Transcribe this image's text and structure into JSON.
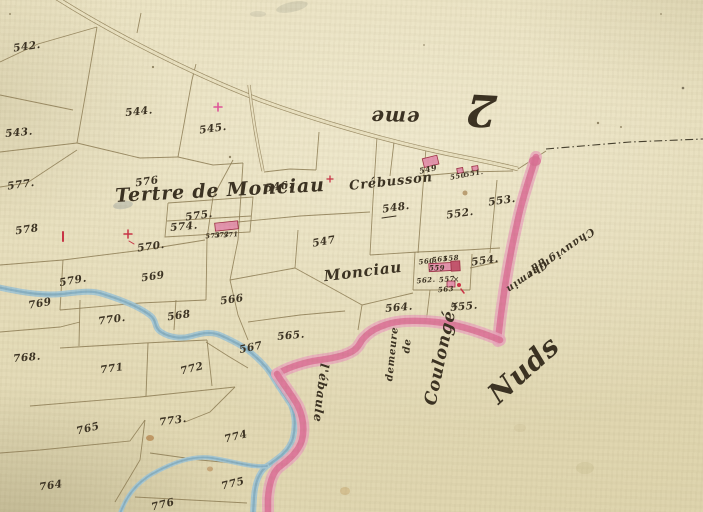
{
  "map": {
    "colors": {
      "paper_light": "#eae2c2",
      "paper_dark": "#ded4ad",
      "ink": "#3a3122",
      "boundary_line": "#8d7c55",
      "water_edge": "#6d9db6",
      "water_fill": "#a3c6d4",
      "road_pink": "#da7195",
      "road_pink_light": "#e9a8bd",
      "building_fill": "#e394ad",
      "building_outline": "#9c2e44",
      "survey_red": "#cb3246",
      "stain_brown": "#a8672a"
    },
    "labels": [
      {
        "id": "tertre-de-monciau",
        "text": "Tertre de Monciau",
        "x": 220,
        "y": 191,
        "rot": -3,
        "size": 19,
        "kind": "script"
      },
      {
        "id": "crebusson",
        "text": "Crébusson",
        "x": 391,
        "y": 182,
        "rot": -6,
        "size": 13,
        "kind": "script"
      },
      {
        "id": "monciau",
        "text": "Monciau",
        "x": 363,
        "y": 272,
        "rot": -7,
        "size": 15,
        "kind": "script"
      },
      {
        "id": "nuds",
        "text": "Nuds",
        "x": 524,
        "y": 370,
        "rot": -42,
        "size": 28,
        "kind": "script"
      },
      {
        "id": "sheet-number",
        "text": "2",
        "x": 481,
        "y": 109,
        "rot": 183,
        "size": 44,
        "kind": "script"
      },
      {
        "id": "sheet-suffix",
        "text": "eme",
        "x": 395,
        "y": 118,
        "rot": 181,
        "size": 20,
        "kind": "script"
      },
      {
        "id": "chemin-line-1",
        "text": "Chemin",
        "x": 526,
        "y": 276,
        "rot": 145,
        "size": 10,
        "kind": "script"
      },
      {
        "id": "chemin-line-2",
        "text": "du",
        "x": 537,
        "y": 264,
        "rot": 145,
        "size": 10,
        "kind": "script"
      },
      {
        "id": "chemin-line-3",
        "text": "Chauvignier",
        "x": 560,
        "y": 253,
        "rot": 145,
        "size": 10.5,
        "kind": "script"
      },
      {
        "id": "demeure",
        "text": "demeure",
        "x": 393,
        "y": 354,
        "rot": -84,
        "size": 10,
        "kind": "script"
      },
      {
        "id": "demeure-de",
        "text": "de",
        "x": 408,
        "y": 346,
        "rot": -84,
        "size": 10,
        "kind": "script"
      },
      {
        "id": "coulonge",
        "text": "Coulongé",
        "x": 441,
        "y": 358,
        "rot": -78,
        "size": 17,
        "kind": "script"
      },
      {
        "id": "ebaule",
        "text": "l'ébaule",
        "x": 321,
        "y": 393,
        "rot": 97,
        "size": 12,
        "kind": "script"
      },
      {
        "id": "parcel-542",
        "text": "542.",
        "x": 27,
        "y": 47,
        "rot": -8,
        "size": 10.5,
        "kind": "number"
      },
      {
        "id": "parcel-543",
        "text": "543.",
        "x": 19,
        "y": 133,
        "rot": -5,
        "size": 10.5,
        "kind": "number"
      },
      {
        "id": "parcel-544",
        "text": "544.",
        "x": 139,
        "y": 112,
        "rot": -6,
        "size": 10.5,
        "kind": "number"
      },
      {
        "id": "parcel-545",
        "text": "545.",
        "x": 213,
        "y": 129,
        "rot": -8,
        "size": 10.5,
        "kind": "number"
      },
      {
        "id": "parcel-546",
        "text": "546.",
        "x": 279,
        "y": 187,
        "rot": -8,
        "size": 10.5,
        "kind": "number"
      },
      {
        "id": "parcel-547",
        "text": "547",
        "x": 324,
        "y": 242,
        "rot": -10,
        "size": 10.5,
        "kind": "number"
      },
      {
        "id": "parcel-548",
        "text": "548.",
        "x": 396,
        "y": 208,
        "rot": -8,
        "size": 10.5,
        "kind": "number"
      },
      {
        "id": "parcel-549",
        "text": "549",
        "x": 428,
        "y": 169,
        "rot": -12,
        "size": 8,
        "kind": "tiny"
      },
      {
        "id": "parcel-550",
        "text": "550",
        "x": 458,
        "y": 176,
        "rot": -10,
        "size": 7,
        "kind": "tiny"
      },
      {
        "id": "parcel-551",
        "text": "551.",
        "x": 474,
        "y": 173,
        "rot": -10,
        "size": 7,
        "kind": "tiny"
      },
      {
        "id": "parcel-552",
        "text": "552.",
        "x": 460,
        "y": 214,
        "rot": -8,
        "size": 10.5,
        "kind": "number"
      },
      {
        "id": "parcel-553",
        "text": "553.",
        "x": 502,
        "y": 201,
        "rot": -8,
        "size": 10.5,
        "kind": "number"
      },
      {
        "id": "parcel-554",
        "text": "554.",
        "x": 485,
        "y": 261,
        "rot": -8,
        "size": 10.5,
        "kind": "number"
      },
      {
        "id": "parcel-555",
        "text": "555.",
        "x": 464,
        "y": 307,
        "rot": -5,
        "size": 10.5,
        "kind": "number"
      },
      {
        "id": "parcel-557",
        "text": "557",
        "x": 447,
        "y": 279,
        "rot": -5,
        "size": 7,
        "kind": "tiny"
      },
      {
        "id": "parcel-558",
        "text": "558",
        "x": 451,
        "y": 258,
        "rot": -5,
        "size": 7,
        "kind": "tiny"
      },
      {
        "id": "parcel-559",
        "text": "559",
        "x": 437,
        "y": 268,
        "rot": 0,
        "size": 7,
        "kind": "tiny"
      },
      {
        "id": "parcel-560",
        "text": "560.",
        "x": 428,
        "y": 261,
        "rot": -5,
        "size": 7,
        "kind": "tiny"
      },
      {
        "id": "parcel-561",
        "text": "561",
        "x": 440,
        "y": 259,
        "rot": -5,
        "size": 7,
        "kind": "tiny"
      },
      {
        "id": "parcel-562",
        "text": "562.",
        "x": 426,
        "y": 280,
        "rot": -5,
        "size": 7,
        "kind": "tiny"
      },
      {
        "id": "parcel-563",
        "text": "563",
        "x": 446,
        "y": 289,
        "rot": -5,
        "size": 7,
        "kind": "tiny"
      },
      {
        "id": "parcel-564",
        "text": "564.",
        "x": 399,
        "y": 308,
        "rot": -5,
        "size": 10.5,
        "kind": "number"
      },
      {
        "id": "parcel-565",
        "text": "565.",
        "x": 291,
        "y": 336,
        "rot": -5,
        "size": 10.5,
        "kind": "number"
      },
      {
        "id": "parcel-566",
        "text": "566",
        "x": 232,
        "y": 300,
        "rot": -8,
        "size": 10.5,
        "kind": "number"
      },
      {
        "id": "parcel-567",
        "text": "567",
        "x": 251,
        "y": 348,
        "rot": -12,
        "size": 10.5,
        "kind": "number"
      },
      {
        "id": "parcel-568",
        "text": "568",
        "x": 179,
        "y": 316,
        "rot": -8,
        "size": 10.5,
        "kind": "number"
      },
      {
        "id": "parcel-569",
        "text": "569",
        "x": 153,
        "y": 277,
        "rot": -8,
        "size": 10.5,
        "kind": "number"
      },
      {
        "id": "parcel-570",
        "text": "570.",
        "x": 151,
        "y": 247,
        "rot": -8,
        "size": 10.5,
        "kind": "number"
      },
      {
        "id": "parcel-571",
        "text": "571",
        "x": 231,
        "y": 235,
        "rot": -5,
        "size": 6.5,
        "kind": "tiny"
      },
      {
        "id": "parcel-572",
        "text": "572",
        "x": 222,
        "y": 235,
        "rot": -5,
        "size": 6.5,
        "kind": "tiny"
      },
      {
        "id": "parcel-573",
        "text": "573",
        "x": 213,
        "y": 236,
        "rot": -5,
        "size": 6.5,
        "kind": "tiny"
      },
      {
        "id": "parcel-574",
        "text": "574.",
        "x": 184,
        "y": 227,
        "rot": -5,
        "size": 10.5,
        "kind": "number"
      },
      {
        "id": "parcel-575",
        "text": "575.",
        "x": 199,
        "y": 216,
        "rot": -8,
        "size": 10.5,
        "kind": "number"
      },
      {
        "id": "parcel-576",
        "text": "576",
        "x": 147,
        "y": 182,
        "rot": -8,
        "size": 10.5,
        "kind": "number"
      },
      {
        "id": "parcel-577",
        "text": "577.",
        "x": 21,
        "y": 185,
        "rot": -8,
        "size": 10.5,
        "kind": "number"
      },
      {
        "id": "parcel-578",
        "text": "578",
        "x": 27,
        "y": 230,
        "rot": -8,
        "size": 10.5,
        "kind": "number"
      },
      {
        "id": "parcel-579",
        "text": "579.",
        "x": 73,
        "y": 281,
        "rot": -10,
        "size": 10.5,
        "kind": "number"
      },
      {
        "id": "parcel-764",
        "text": "764",
        "x": 51,
        "y": 486,
        "rot": -8,
        "size": 10.5,
        "kind": "number"
      },
      {
        "id": "parcel-765",
        "text": "765",
        "x": 88,
        "y": 429,
        "rot": -14,
        "size": 10.5,
        "kind": "number"
      },
      {
        "id": "parcel-768",
        "text": "768.",
        "x": 27,
        "y": 358,
        "rot": -5,
        "size": 10.5,
        "kind": "number"
      },
      {
        "id": "parcel-769",
        "text": "769",
        "x": 40,
        "y": 304,
        "rot": -10,
        "size": 10.5,
        "kind": "number"
      },
      {
        "id": "parcel-770",
        "text": "770.",
        "x": 112,
        "y": 320,
        "rot": -8,
        "size": 10.5,
        "kind": "number"
      },
      {
        "id": "parcel-771",
        "text": "771",
        "x": 112,
        "y": 369,
        "rot": -8,
        "size": 10.5,
        "kind": "number"
      },
      {
        "id": "parcel-772",
        "text": "772",
        "x": 192,
        "y": 369,
        "rot": -14,
        "size": 10.5,
        "kind": "number"
      },
      {
        "id": "parcel-773",
        "text": "773.",
        "x": 173,
        "y": 421,
        "rot": -8,
        "size": 10.5,
        "kind": "number"
      },
      {
        "id": "parcel-774",
        "text": "774",
        "x": 236,
        "y": 437,
        "rot": -14,
        "size": 10.5,
        "kind": "number"
      },
      {
        "id": "parcel-775",
        "text": "775",
        "x": 233,
        "y": 484,
        "rot": -14,
        "size": 10.5,
        "kind": "number"
      },
      {
        "id": "parcel-776",
        "text": "776",
        "x": 163,
        "y": 505,
        "rot": -14,
        "size": 10.5,
        "kind": "number"
      },
      {
        "id": "check-mark-555",
        "text": "×",
        "x": 455,
        "y": 306,
        "rot": 0,
        "size": 10,
        "kind": "mark"
      },
      {
        "id": "check-mark-557",
        "text": "×",
        "x": 456,
        "y": 280,
        "rot": 0,
        "size": 8,
        "kind": "mark"
      }
    ]
  }
}
